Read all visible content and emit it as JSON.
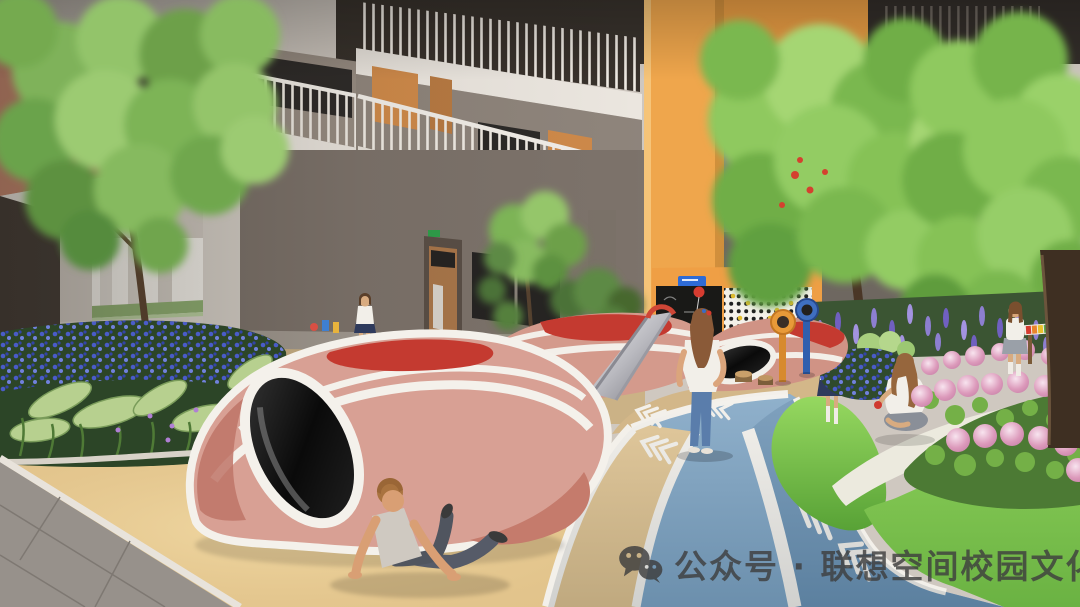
{
  "watermark": {
    "icon": "wechat-icon",
    "text": "公众号 · 联想空间校园文化",
    "color": "#3e3e3e"
  },
  "palette": {
    "accent_orange": "#EFA64C",
    "facade_pink": "#C5876F",
    "wall_light": "#CFC8C0",
    "wall_dark": "#6E665F",
    "mound_pink": "#D8A094",
    "mound_rose": "#BE7467",
    "mound_red": "#C43A30",
    "track_blue": "#7BA2C2",
    "track_blue_deep": "#6890B2",
    "lane_beige": "#DFC18C",
    "sand": "#E4C68F",
    "grass": "#7DC24F",
    "foliage": "#7DB457",
    "flower_blue": "#4A5CC8",
    "flower_purple": "#8D7FD0",
    "flower_pink": "#E3A8C6",
    "white_line": "#F3F0EA"
  },
  "scene": {
    "setting": "kindergarten courtyard playground rendering",
    "people_count": 6,
    "objects": [
      "multi-storey building with white walkway bridges and balcony railings",
      "orange feature tower",
      "orange activity wall with chalkboard and climbing panel",
      "two blue sign plates on activity wall",
      "red balloon drawing on chalkboard",
      "colorful play mounds with white stripes, crawl tunnels and a slide",
      "blue rubber running track with white lane lines and chevron arrows",
      "beige lane and sand play pit",
      "grey paved walkway corner",
      "flower bed with blue flowers and tropical leaves",
      "pink hydrangea bed",
      "lavender border",
      "grass mound and lawn",
      "courtyard trees",
      "orange and blue periscope viewers",
      "rainbow xylophone play panel",
      "boy reclining in sand",
      "girl standing on track",
      "girl walking in distance",
      "girl standing by flower bed",
      "girl sitting on white path",
      "girl playing xylophone",
      "WeChat watermark"
    ]
  }
}
